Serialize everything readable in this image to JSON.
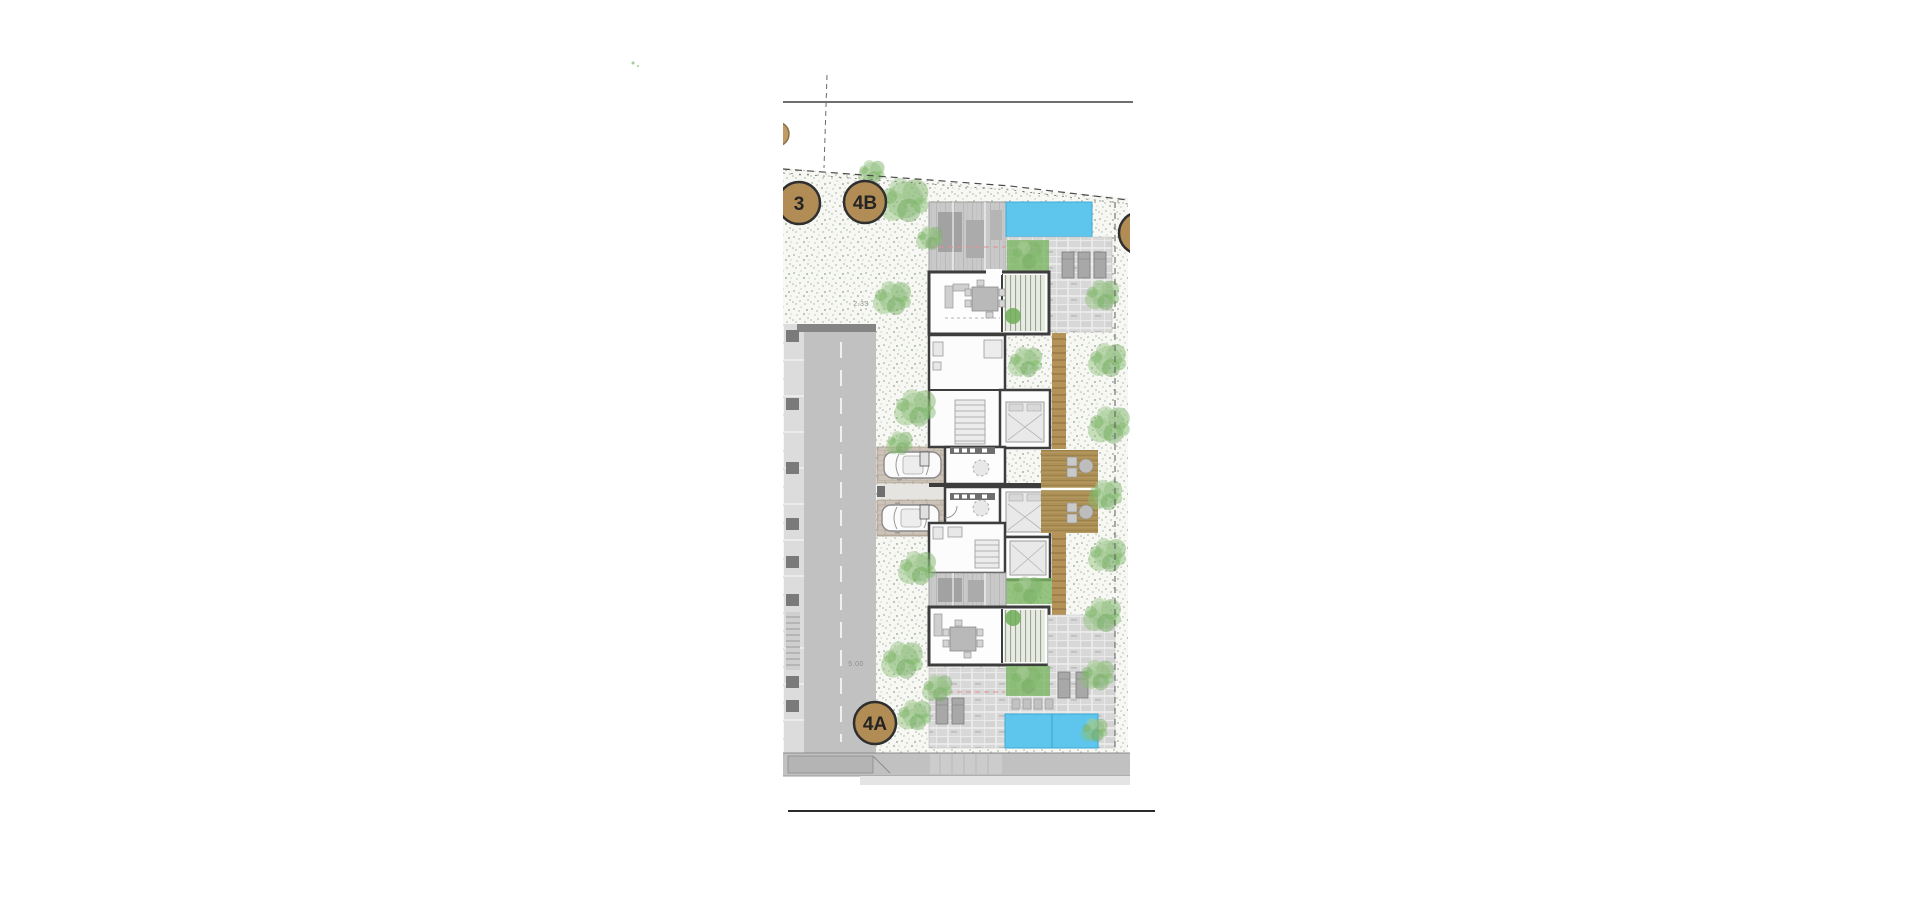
{
  "document": {
    "type": "architectural-site-plan",
    "description": "semi-detached villas plot plan"
  },
  "badges": [
    {
      "id": "plot-3",
      "label": "3"
    },
    {
      "id": "plot-4b",
      "label": "4B"
    },
    {
      "id": "plot-4a",
      "label": "4A"
    }
  ],
  "dimensions": [
    {
      "id": "dim-top",
      "label": "2.33"
    },
    {
      "id": "dim-road",
      "label": "5.00"
    }
  ],
  "colors": {
    "background": "#ffffff",
    "gravel_dots": "#b7c2b1",
    "road": "#c1c1c1",
    "road_curb": "#828282",
    "sidewalk": "#dcdcdc",
    "wall": "#3d3d3d",
    "room": "#fdfdfd",
    "roof_hatch": "#c9c9c9",
    "paver": "#d8d8d8",
    "brick": "#cdc3b8",
    "pool": "#5ec6ec",
    "pool_edge": "#3fa9d6",
    "deck": "#ab8f55",
    "steps": "#b59258",
    "vegetation": "#7eb468",
    "badge_fill": "#b28c55",
    "badge_border": "#2f2f2f",
    "boundary_dash": "#4a4a4a",
    "roof_overhang_dash": "#e09090"
  }
}
